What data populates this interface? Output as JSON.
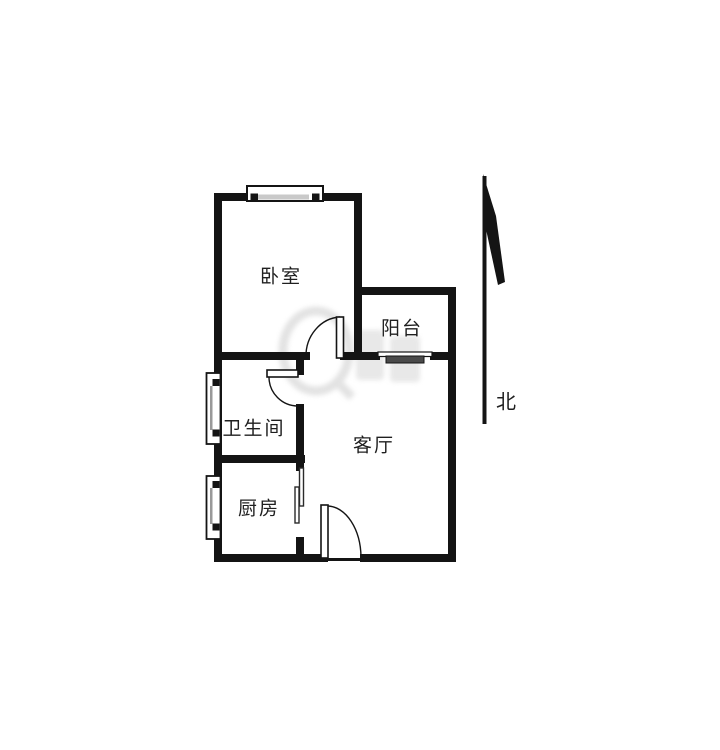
{
  "floor_plan": {
    "rooms": [
      {
        "id": "bedroom",
        "label": "卧室"
      },
      {
        "id": "balcony",
        "label": "阳台"
      },
      {
        "id": "bathroom",
        "label": "卫生间"
      },
      {
        "id": "kitchen",
        "label": "厨房"
      },
      {
        "id": "living-room",
        "label": "客厅"
      }
    ],
    "compass": {
      "north_label": "北"
    },
    "colors": {
      "wall": "#141414",
      "label_text": "#1f1f1f",
      "watermark": "#e0e0e0",
      "sliding_panel": "#4a4a4a",
      "background": "#ffffff"
    }
  }
}
